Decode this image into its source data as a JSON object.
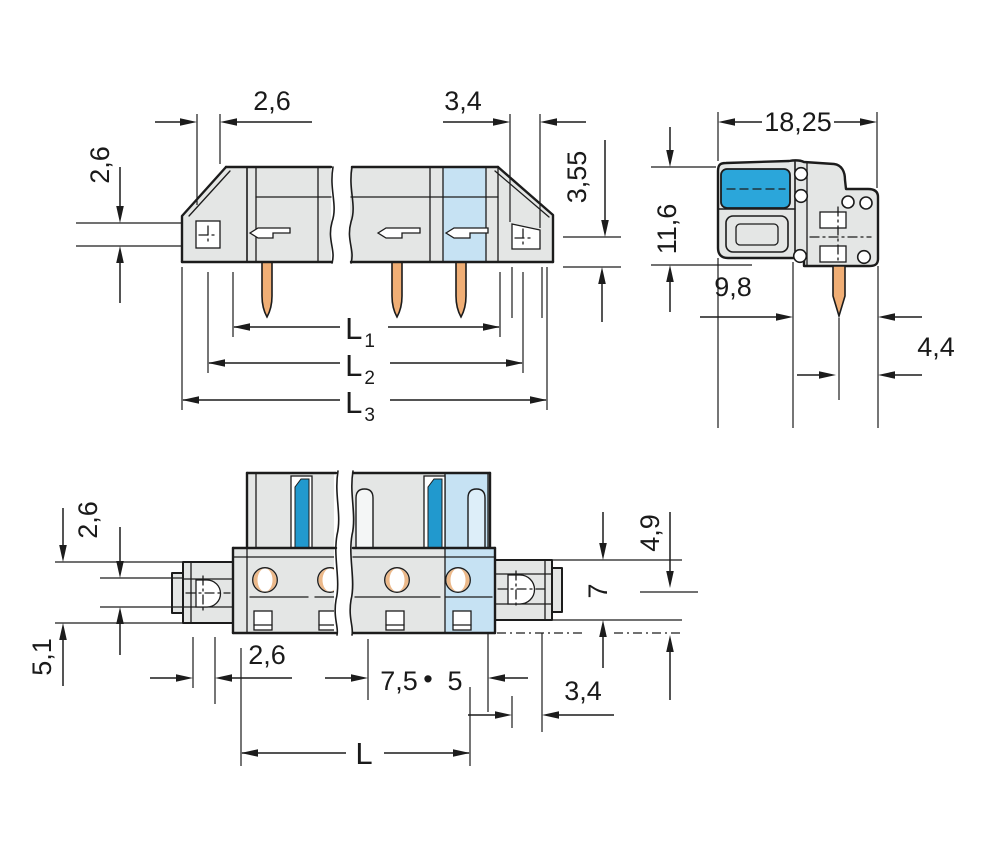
{
  "title": "connector-dimensional-drawing",
  "colors": {
    "background": "#ffffff",
    "line": "#1c1c1c",
    "body_gray": "#e4e6e5",
    "light_blue": "#c6e2f3",
    "stripe_blue": "#2199ce",
    "side_block_blue": "#2ba6da",
    "pin_tan": "#f0ae75"
  },
  "labels": {
    "front": {
      "width_left": "2,6",
      "width_right": "3,4",
      "height_left": "2,6",
      "height_right": "3,55",
      "l1": "L",
      "l1_sub": "1",
      "l2": "L",
      "l2_sub": "2",
      "l3": "L",
      "l3_sub": "3"
    },
    "side": {
      "width": "18,25",
      "height": "11,6",
      "depth": "9,8",
      "pin_to_edge": "4,4"
    },
    "bottom": {
      "offset_upper": "2,6",
      "offset_lower": "5,1",
      "flange_width": "2,6",
      "pitch": "7,5",
      "pitch_separator": "•",
      "pitch_alt": "5",
      "center_offset": "4,9",
      "flange_height": "7",
      "flange_depth": "3,4",
      "total_length": "L"
    }
  }
}
